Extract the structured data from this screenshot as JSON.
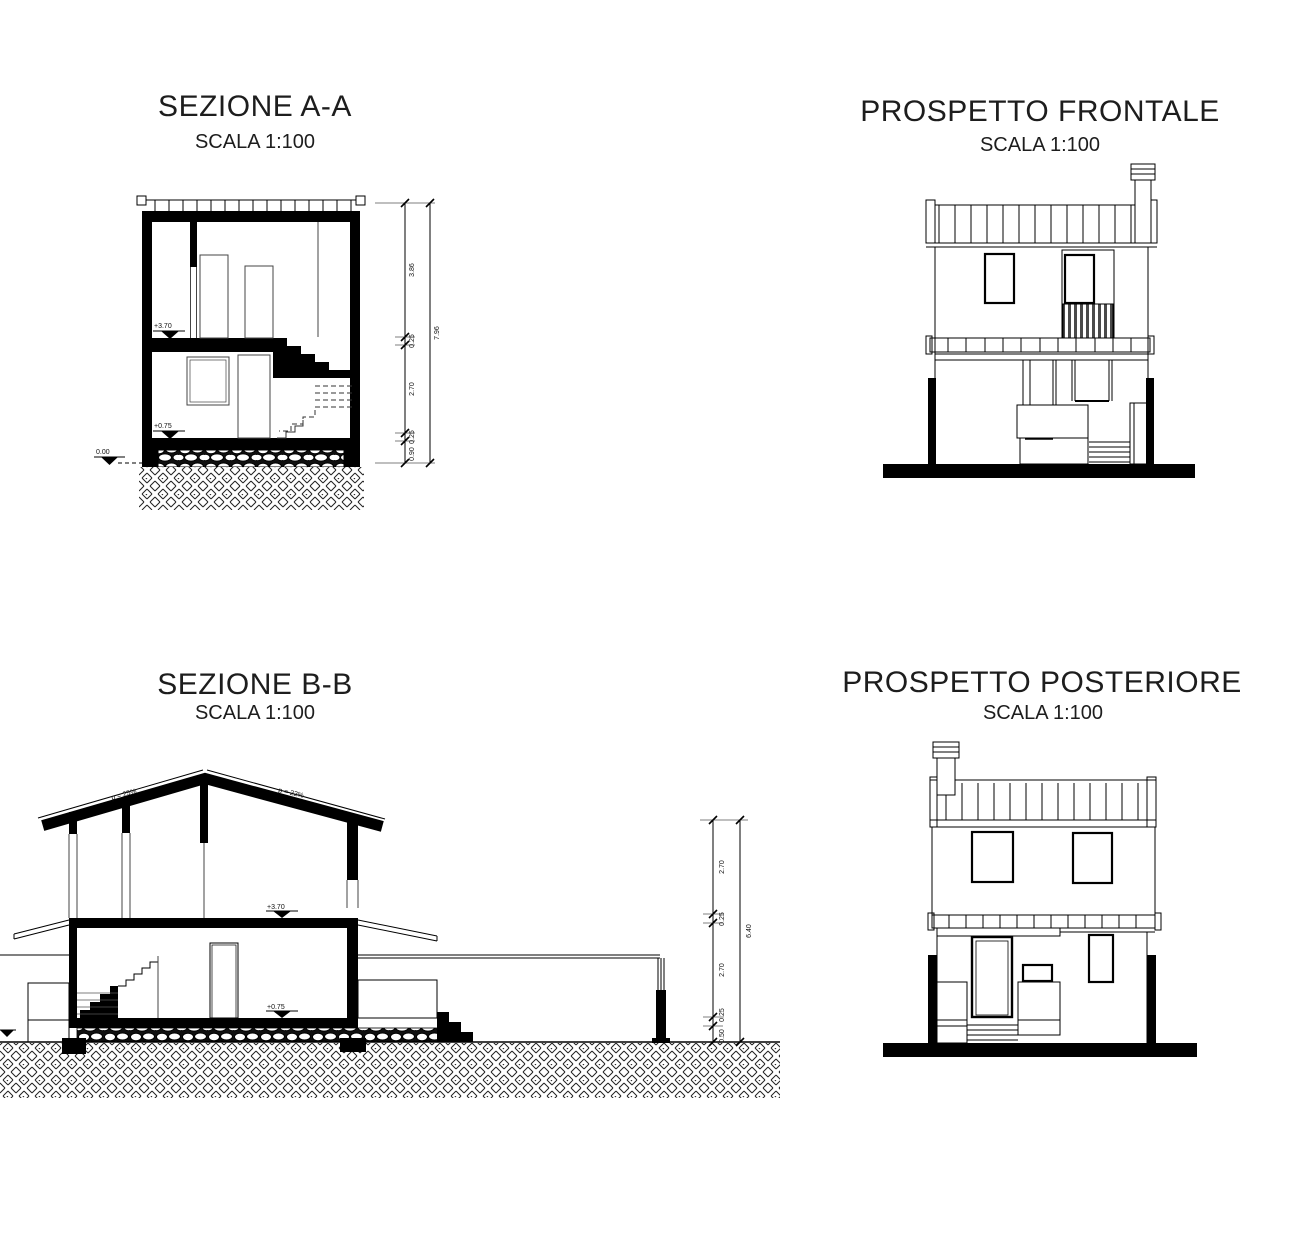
{
  "sheet": {
    "background": "#ffffff",
    "ink": "#000000"
  },
  "panels": {
    "sezione_aa": {
      "title": "SEZIONE A-A",
      "scale": "SCALA 1:100",
      "levels": {
        "upper": "+3.70",
        "ground_floor": "+0.75",
        "zero": "0.00"
      },
      "dims": [
        "3.86",
        "0.25",
        "2.70",
        "0.25",
        "0.90"
      ],
      "total": "7.96"
    },
    "prospetto_frontale": {
      "title": "PROSPETTO FRONTALE",
      "scale": "SCALA 1:100"
    },
    "sezione_bb": {
      "title": "SEZIONE B-B",
      "scale": "SCALA 1:100",
      "slope_left": "p = 25%",
      "slope_right": "p = 22%",
      "levels": {
        "upper": "+3.70",
        "ground_floor": "+0.75"
      },
      "dims": [
        "2.70",
        "0.25",
        "2.70",
        "0.25",
        "0.50"
      ],
      "total": "6.40"
    },
    "prospetto_posteriore": {
      "title": "PROSPETTO POSTERIORE",
      "scale": "SCALA 1:100"
    }
  }
}
